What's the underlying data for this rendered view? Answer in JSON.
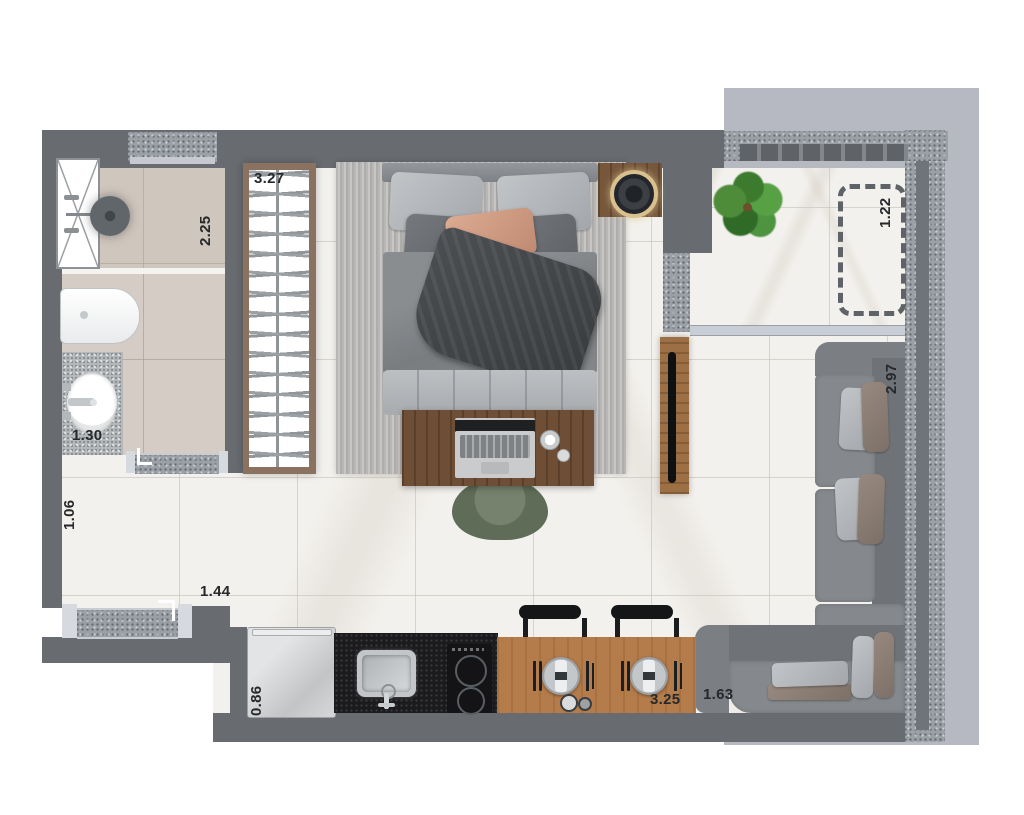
{
  "plan": {
    "labels": {
      "shower": "2.25",
      "wardrobe": "3.27",
      "balcony": "1.22",
      "living_wall": "2.97",
      "vanity": "1.30",
      "hall": "1.06",
      "entry": "1.44",
      "fridge": "0.86",
      "kitchen": "3.25",
      "chaise": "1.63"
    },
    "colors": {
      "wall": "#686c71",
      "slab": "#b6b9c2",
      "floor_marble": "#f3f1ed",
      "bathroom_tile": "#d4ccc5",
      "wood_table": "#b57c4b",
      "wood_desk": "#6e4f36",
      "kitchen_counter": "#1b1b1e",
      "sofa": "#85898d",
      "accent_pillow": "#d09a82",
      "plant_green": "#4c8a3c",
      "desk_chair_green": "#67745f"
    }
  }
}
